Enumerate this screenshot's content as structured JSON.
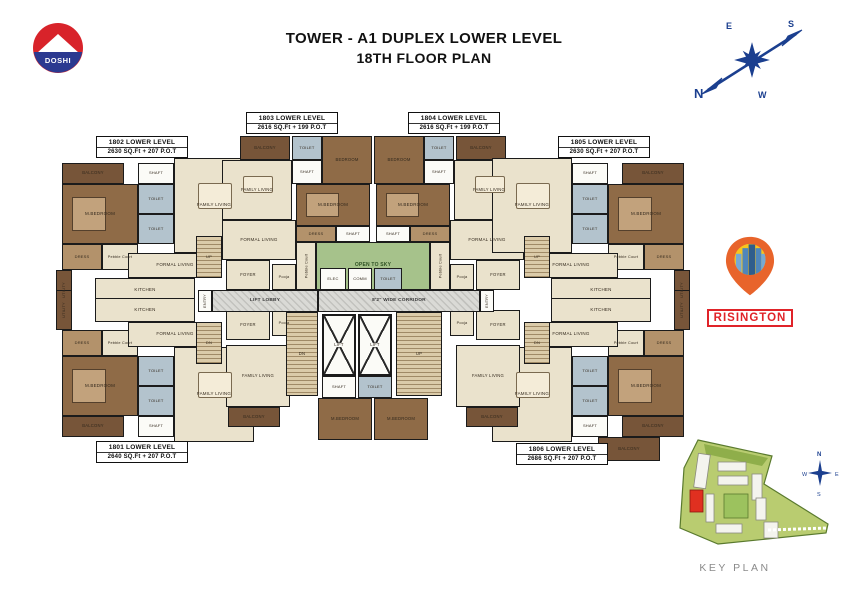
{
  "title": {
    "line1": "TOWER - A1 DUPLEX LOWER LEVEL",
    "line2": "18TH FLOOR PLAN"
  },
  "doshi": {
    "text": "DOSHI",
    "red": "#d8232a",
    "blue": "#2b3990"
  },
  "compass": {
    "n": "N",
    "e": "E",
    "s": "S",
    "w": "W",
    "color": "#1b3f8f"
  },
  "risington": {
    "name": "RISINGTON",
    "red": "#e02329",
    "pin_orange": "#e8642b",
    "pin_yellow": "#f6c51f",
    "building_blue": "#2f5d8c"
  },
  "key_plan": {
    "label": "KEY PLAN",
    "highlight_unit": "A1",
    "compass": {
      "n": "N",
      "e": "E",
      "s": "S",
      "w": "W"
    }
  },
  "colors": {
    "floor": "#eae2cc",
    "bed": "#8f6b47",
    "dress": "#b3926b",
    "toilet": "#b3c3cd",
    "balc": "#775539",
    "green": "#a6c28b",
    "stair": "#dbcba9",
    "corr": "#d2d2ce",
    "white": "#fbfbf7",
    "wall": "#1b1b1b"
  },
  "units": [
    {
      "id": "1802",
      "label": "1802 LOWER LEVEL",
      "area": "2630 SQ.Ft + 207 P.O.T",
      "box": {
        "x": 96,
        "y": 136,
        "w": 92,
        "h": 22
      },
      "rooms": [
        {
          "l": "BALCONY",
          "x": 62,
          "y": 163,
          "w": 62,
          "h": 21,
          "c": "balc",
          "fs": 4.2
        },
        {
          "l": "M.BEDROOM",
          "x": 62,
          "y": 184,
          "w": 76,
          "h": 60,
          "c": "bed",
          "cls": "bed",
          "fs": 4.5
        },
        {
          "l": "SHAFT",
          "x": 138,
          "y": 163,
          "w": 36,
          "h": 21,
          "c": "white",
          "fs": 4
        },
        {
          "l": "TOILET",
          "x": 138,
          "y": 184,
          "w": 36,
          "h": 30,
          "c": "toilet",
          "fs": 4
        },
        {
          "l": "TOILET",
          "x": 138,
          "y": 214,
          "w": 36,
          "h": 30,
          "c": "toilet",
          "fs": 4
        },
        {
          "l": "DRESS",
          "x": 62,
          "y": 244,
          "w": 40,
          "h": 26,
          "c": "dress",
          "fs": 4
        },
        {
          "l": "Pebble Court",
          "x": 102,
          "y": 244,
          "w": 36,
          "h": 26,
          "c": "floor",
          "fs": 3.8
        },
        {
          "l": "FAMILY LIVING",
          "x": 174,
          "y": 158,
          "w": 80,
          "h": 95,
          "c": "floor",
          "cls": "dine",
          "fs": 4.5
        },
        {
          "l": "FORMAL LIVING",
          "x": 128,
          "y": 253,
          "w": 94,
          "h": 25,
          "c": "floor",
          "fs": 4.5
        },
        {
          "l": "KITCHEN",
          "x": 95,
          "y": 278,
          "w": 100,
          "h": 24,
          "c": "floor",
          "fs": 4.5
        },
        {
          "l": "FOYER",
          "x": 226,
          "y": 260,
          "w": 44,
          "h": 30,
          "c": "floor",
          "fs": 4.2
        },
        {
          "l": "UTILITY",
          "x": 56,
          "y": 270,
          "w": 16,
          "h": 40,
          "c": "balc",
          "rot": 1,
          "fs": 3.8
        },
        {
          "l": "UP",
          "x": 196,
          "y": 236,
          "w": 26,
          "h": 42,
          "c": "stair",
          "cls": "stair",
          "fs": 4
        }
      ]
    },
    {
      "id": "1803",
      "label": "1803 LOWER LEVEL",
      "area": "2616 SQ.Ft + 199 P.O.T",
      "box": {
        "x": 246,
        "y": 112,
        "w": 92,
        "h": 22
      },
      "rooms": [
        {
          "l": "BALCONY",
          "x": 240,
          "y": 136,
          "w": 50,
          "h": 24,
          "c": "balc",
          "fs": 4.2
        },
        {
          "l": "TOILET",
          "x": 292,
          "y": 136,
          "w": 30,
          "h": 24,
          "c": "toilet",
          "fs": 4
        },
        {
          "l": "SHAFT",
          "x": 292,
          "y": 160,
          "w": 30,
          "h": 24,
          "c": "white",
          "fs": 4
        },
        {
          "l": "BEDROOM",
          "x": 322,
          "y": 136,
          "w": 50,
          "h": 48,
          "c": "bed",
          "fs": 4.2
        },
        {
          "l": "FAMILY LIVING",
          "x": 222,
          "y": 160,
          "w": 70,
          "h": 60,
          "c": "floor",
          "cls": "dine",
          "fs": 4.2
        },
        {
          "l": "M.BEDROOM",
          "x": 296,
          "y": 184,
          "w": 74,
          "h": 42,
          "c": "bed",
          "cls": "bed",
          "fs": 4.5
        },
        {
          "l": "DRESS",
          "x": 296,
          "y": 226,
          "w": 40,
          "h": 16,
          "c": "dress",
          "fs": 4
        },
        {
          "l": "SHAFT",
          "x": 336,
          "y": 226,
          "w": 34,
          "h": 16,
          "c": "white",
          "fs": 4
        },
        {
          "l": "FORMAL LIVING",
          "x": 222,
          "y": 220,
          "w": 74,
          "h": 40,
          "c": "floor",
          "fs": 4.5
        },
        {
          "l": "Pooja",
          "x": 272,
          "y": 264,
          "w": 24,
          "h": 26,
          "c": "floor",
          "fs": 3.8
        },
        {
          "l": "Pebble Court",
          "x": 296,
          "y": 242,
          "w": 20,
          "h": 48,
          "c": "floor",
          "rot": 1,
          "fs": 3.8
        }
      ]
    },
    {
      "id": "1804",
      "label": "1804 LOWER LEVEL",
      "area": "2616 SQ.Ft + 199 P.O.T",
      "box": {
        "x": 408,
        "y": 112,
        "w": 92,
        "h": 22
      },
      "rooms": [
        {
          "l": "BALCONY",
          "x": 456,
          "y": 136,
          "w": 50,
          "h": 24,
          "c": "balc",
          "fs": 4.2
        },
        {
          "l": "TOILET",
          "x": 424,
          "y": 136,
          "w": 30,
          "h": 24,
          "c": "toilet",
          "fs": 4
        },
        {
          "l": "SHAFT",
          "x": 424,
          "y": 160,
          "w": 30,
          "h": 24,
          "c": "white",
          "fs": 4
        },
        {
          "l": "BEDROOM",
          "x": 374,
          "y": 136,
          "w": 50,
          "h": 48,
          "c": "bed",
          "fs": 4.2
        },
        {
          "l": "FAMILY LIVING",
          "x": 454,
          "y": 160,
          "w": 70,
          "h": 60,
          "c": "floor",
          "cls": "dine",
          "fs": 4.2
        },
        {
          "l": "M.BEDROOM",
          "x": 376,
          "y": 184,
          "w": 74,
          "h": 42,
          "c": "bed",
          "cls": "bed",
          "fs": 4.5
        },
        {
          "l": "DRESS",
          "x": 410,
          "y": 226,
          "w": 40,
          "h": 16,
          "c": "dress",
          "fs": 4
        },
        {
          "l": "SHAFT",
          "x": 376,
          "y": 226,
          "w": 34,
          "h": 16,
          "c": "white",
          "fs": 4
        },
        {
          "l": "FORMAL LIVING",
          "x": 450,
          "y": 220,
          "w": 74,
          "h": 40,
          "c": "floor",
          "fs": 4.5
        },
        {
          "l": "Pooja",
          "x": 450,
          "y": 264,
          "w": 24,
          "h": 26,
          "c": "floor",
          "fs": 3.8
        },
        {
          "l": "Pebble Court",
          "x": 430,
          "y": 242,
          "w": 20,
          "h": 48,
          "c": "floor",
          "rot": 1,
          "fs": 3.8
        }
      ]
    },
    {
      "id": "1805",
      "label": "1805 LOWER LEVEL",
      "area": "2630 SQ.Ft + 207 P.O.T",
      "box": {
        "x": 558,
        "y": 136,
        "w": 92,
        "h": 22
      },
      "rooms": [
        {
          "l": "BALCONY",
          "x": 622,
          "y": 163,
          "w": 62,
          "h": 21,
          "c": "balc",
          "fs": 4.2
        },
        {
          "l": "M.BEDROOM",
          "x": 608,
          "y": 184,
          "w": 76,
          "h": 60,
          "c": "bed",
          "cls": "bed",
          "fs": 4.5
        },
        {
          "l": "SHAFT",
          "x": 572,
          "y": 163,
          "w": 36,
          "h": 21,
          "c": "white",
          "fs": 4
        },
        {
          "l": "TOILET",
          "x": 572,
          "y": 184,
          "w": 36,
          "h": 30,
          "c": "toilet",
          "fs": 4
        },
        {
          "l": "TOILET",
          "x": 572,
          "y": 214,
          "w": 36,
          "h": 30,
          "c": "toilet",
          "fs": 4
        },
        {
          "l": "DRESS",
          "x": 644,
          "y": 244,
          "w": 40,
          "h": 26,
          "c": "dress",
          "fs": 4
        },
        {
          "l": "Pebble Court",
          "x": 608,
          "y": 244,
          "w": 36,
          "h": 26,
          "c": "floor",
          "fs": 3.8
        },
        {
          "l": "FAMILY LIVING",
          "x": 492,
          "y": 158,
          "w": 80,
          "h": 95,
          "c": "floor",
          "cls": "dine",
          "fs": 4.5
        },
        {
          "l": "FORMAL LIVING",
          "x": 524,
          "y": 253,
          "w": 94,
          "h": 25,
          "c": "floor",
          "fs": 4.5
        },
        {
          "l": "KITCHEN",
          "x": 551,
          "y": 278,
          "w": 100,
          "h": 24,
          "c": "floor",
          "fs": 4.5
        },
        {
          "l": "FOYER",
          "x": 476,
          "y": 260,
          "w": 44,
          "h": 30,
          "c": "floor",
          "fs": 4.2
        },
        {
          "l": "UTILITY",
          "x": 674,
          "y": 270,
          "w": 16,
          "h": 40,
          "c": "balc",
          "rot": 1,
          "fs": 3.8
        },
        {
          "l": "UP",
          "x": 524,
          "y": 236,
          "w": 26,
          "h": 42,
          "c": "stair",
          "cls": "stair",
          "fs": 4
        }
      ]
    },
    {
      "id": "1801",
      "label": "1801 LOWER LEVEL",
      "area": "2640 SQ.Ft + 207 P.O.T",
      "box": {
        "x": 96,
        "y": 441,
        "w": 92,
        "h": 22
      },
      "rooms": [
        {
          "l": "BALCONY",
          "x": 62,
          "y": 416,
          "w": 62,
          "h": 21,
          "c": "balc",
          "fs": 4.2
        },
        {
          "l": "M.BEDROOM",
          "x": 62,
          "y": 356,
          "w": 76,
          "h": 60,
          "c": "bed",
          "cls": "bed",
          "fs": 4.5
        },
        {
          "l": "SHAFT",
          "x": 138,
          "y": 416,
          "w": 36,
          "h": 21,
          "c": "white",
          "fs": 4
        },
        {
          "l": "TOILET",
          "x": 138,
          "y": 356,
          "w": 36,
          "h": 30,
          "c": "toilet",
          "fs": 4
        },
        {
          "l": "TOILET",
          "x": 138,
          "y": 386,
          "w": 36,
          "h": 30,
          "c": "toilet",
          "fs": 4
        },
        {
          "l": "DRESS",
          "x": 62,
          "y": 330,
          "w": 40,
          "h": 26,
          "c": "dress",
          "fs": 4
        },
        {
          "l": "Pebble Court",
          "x": 102,
          "y": 330,
          "w": 36,
          "h": 26,
          "c": "floor",
          "fs": 3.8
        },
        {
          "l": "FAMILY LIVING",
          "x": 174,
          "y": 347,
          "w": 80,
          "h": 95,
          "c": "floor",
          "cls": "dine",
          "fs": 4.5
        },
        {
          "l": "FORMAL LIVING",
          "x": 128,
          "y": 322,
          "w": 94,
          "h": 25,
          "c": "floor",
          "fs": 4.5
        },
        {
          "l": "KITCHEN",
          "x": 95,
          "y": 298,
          "w": 100,
          "h": 24,
          "c": "floor",
          "fs": 4.5
        },
        {
          "l": "FOYER",
          "x": 226,
          "y": 310,
          "w": 44,
          "h": 30,
          "c": "floor",
          "fs": 4.2
        },
        {
          "l": "Pooja",
          "x": 272,
          "y": 310,
          "w": 24,
          "h": 26,
          "c": "floor",
          "fs": 3.8
        },
        {
          "l": "UTILITY",
          "x": 56,
          "y": 290,
          "w": 16,
          "h": 40,
          "c": "balc",
          "rot": 1,
          "fs": 3.8
        },
        {
          "l": "DN",
          "x": 196,
          "y": 322,
          "w": 26,
          "h": 42,
          "c": "stair",
          "cls": "stair",
          "fs": 4
        },
        {
          "l": "FAMILY LIVING",
          "x": 226,
          "y": 345,
          "w": 64,
          "h": 62,
          "c": "floor",
          "fs": 4.2
        },
        {
          "l": "BALCONY",
          "x": 228,
          "y": 407,
          "w": 52,
          "h": 20,
          "c": "balc",
          "fs": 4.2
        },
        {
          "l": "M.BEDROOM",
          "x": 318,
          "y": 398,
          "w": 54,
          "h": 42,
          "c": "bed",
          "fs": 4.2
        }
      ]
    },
    {
      "id": "1806",
      "label": "1806 LOWER LEVEL",
      "area": "2686 SQ.Ft + 207 P.O.T",
      "box": {
        "x": 516,
        "y": 443,
        "w": 92,
        "h": 22
      },
      "rooms": [
        {
          "l": "BALCONY",
          "x": 622,
          "y": 416,
          "w": 62,
          "h": 21,
          "c": "balc",
          "fs": 4.2
        },
        {
          "l": "M.BEDROOM",
          "x": 608,
          "y": 356,
          "w": 76,
          "h": 60,
          "c": "bed",
          "cls": "bed",
          "fs": 4.5
        },
        {
          "l": "SHAFT",
          "x": 572,
          "y": 416,
          "w": 36,
          "h": 21,
          "c": "white",
          "fs": 4
        },
        {
          "l": "TOILET",
          "x": 572,
          "y": 356,
          "w": 36,
          "h": 30,
          "c": "toilet",
          "fs": 4
        },
        {
          "l": "TOILET",
          "x": 572,
          "y": 386,
          "w": 36,
          "h": 30,
          "c": "toilet",
          "fs": 4
        },
        {
          "l": "DRESS",
          "x": 644,
          "y": 330,
          "w": 40,
          "h": 26,
          "c": "dress",
          "fs": 4
        },
        {
          "l": "Pebble Court",
          "x": 608,
          "y": 330,
          "w": 36,
          "h": 26,
          "c": "floor",
          "fs": 3.8
        },
        {
          "l": "FAMILY LIVING",
          "x": 492,
          "y": 347,
          "w": 80,
          "h": 95,
          "c": "floor",
          "cls": "dine",
          "fs": 4.5
        },
        {
          "l": "FORMAL LIVING",
          "x": 524,
          "y": 322,
          "w": 94,
          "h": 25,
          "c": "floor",
          "fs": 4.5
        },
        {
          "l": "KITCHEN",
          "x": 551,
          "y": 298,
          "w": 100,
          "h": 24,
          "c": "floor",
          "fs": 4.5
        },
        {
          "l": "FOYER",
          "x": 476,
          "y": 310,
          "w": 44,
          "h": 30,
          "c": "floor",
          "fs": 4.2
        },
        {
          "l": "Pooja",
          "x": 450,
          "y": 310,
          "w": 24,
          "h": 26,
          "c": "floor",
          "fs": 3.8
        },
        {
          "l": "UTILITY",
          "x": 674,
          "y": 290,
          "w": 16,
          "h": 40,
          "c": "balc",
          "rot": 1,
          "fs": 3.8
        },
        {
          "l": "DN",
          "x": 524,
          "y": 322,
          "w": 26,
          "h": 42,
          "c": "stair",
          "cls": "stair",
          "fs": 4
        },
        {
          "l": "FAMILY LIVING",
          "x": 456,
          "y": 345,
          "w": 64,
          "h": 62,
          "c": "floor",
          "fs": 4.2
        },
        {
          "l": "BALCONY",
          "x": 466,
          "y": 407,
          "w": 52,
          "h": 20,
          "c": "balc",
          "fs": 4.2
        },
        {
          "l": "M.BEDROOM",
          "x": 374,
          "y": 398,
          "w": 54,
          "h": 42,
          "c": "bed",
          "fs": 4.2
        },
        {
          "l": "BALCONY",
          "x": 598,
          "y": 437,
          "w": 62,
          "h": 24,
          "c": "balc",
          "fs": 4.2
        }
      ]
    }
  ],
  "common": {
    "rooms": [
      {
        "l": "OPEN TO SKY",
        "x": 316,
        "y": 242,
        "w": 114,
        "h": 48,
        "c": "green",
        "cls": "green",
        "fs": 5
      },
      {
        "l": "ELEC",
        "x": 320,
        "y": 268,
        "w": 26,
        "h": 22,
        "c": "white",
        "fs": 4
      },
      {
        "l": "COMM",
        "x": 348,
        "y": 268,
        "w": 24,
        "h": 22,
        "c": "white",
        "fs": 4
      },
      {
        "l": "TOILET",
        "x": 374,
        "y": 268,
        "w": 28,
        "h": 22,
        "c": "toilet",
        "fs": 4
      },
      {
        "l": "ENTRY",
        "x": 198,
        "y": 290,
        "w": 14,
        "h": 22,
        "c": "white",
        "rot": 1,
        "fs": 3.8
      },
      {
        "l": "LIFT LOBBY",
        "x": 212,
        "y": 290,
        "w": 106,
        "h": 22,
        "c": "corr",
        "cls": "corr",
        "fs": 4.8
      },
      {
        "l": "8'2\" WIDE CORRIDOR",
        "x": 318,
        "y": 290,
        "w": 162,
        "h": 22,
        "c": "corr",
        "cls": "corr",
        "fs": 4.8
      },
      {
        "l": "ENTRY",
        "x": 480,
        "y": 290,
        "w": 14,
        "h": 22,
        "c": "white",
        "rot": 1,
        "fs": 3.8
      },
      {
        "l": "DN",
        "x": 286,
        "y": 312,
        "w": 32,
        "h": 84,
        "c": "stair",
        "cls": "stair",
        "fs": 4.2
      },
      {
        "l": "LIFT",
        "x": 322,
        "y": 314,
        "w": 34,
        "h": 62,
        "c": "white",
        "cls": "lift",
        "fs": 4.2
      },
      {
        "l": "LIFT",
        "x": 358,
        "y": 314,
        "w": 34,
        "h": 62,
        "c": "white",
        "cls": "lift",
        "fs": 4.2
      },
      {
        "l": "UP",
        "x": 396,
        "y": 312,
        "w": 46,
        "h": 84,
        "c": "stair",
        "cls": "stair",
        "fs": 4.2
      },
      {
        "l": "SHAFT",
        "x": 322,
        "y": 376,
        "w": 34,
        "h": 22,
        "c": "white",
        "fs": 4
      },
      {
        "l": "TOILET",
        "x": 358,
        "y": 376,
        "w": 34,
        "h": 22,
        "c": "toilet",
        "fs": 4
      }
    ]
  }
}
